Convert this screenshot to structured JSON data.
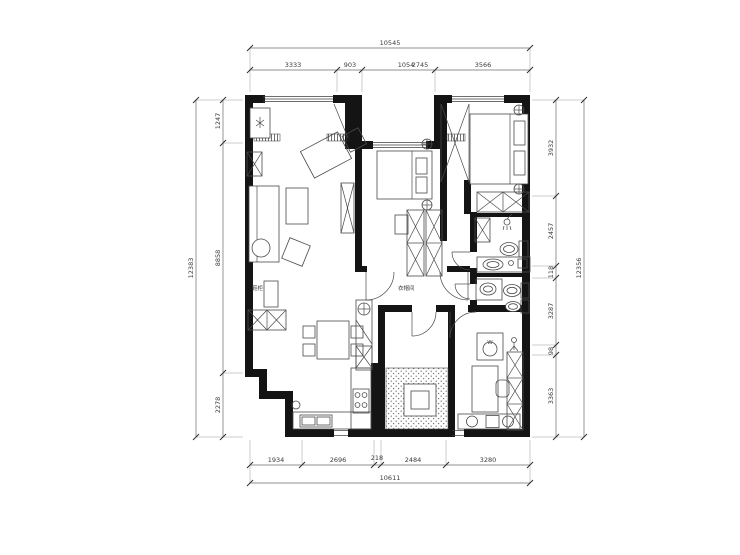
{
  "drawing": {
    "kind": "apartment floor plan (CAD line drawing with dimension chains)",
    "units": "mm"
  },
  "dims": {
    "top": {
      "total": "10545",
      "s1": "3333",
      "s2": "903",
      "s3a": "1054",
      "s3b": "2745",
      "s4": "3566"
    },
    "bottom": {
      "total": "10611",
      "s1": "1934",
      "s2": "2696",
      "s3": "218",
      "s4": "2484",
      "s5": "3280"
    },
    "left": {
      "total": "12383",
      "s1": "1247",
      "s2": "8858",
      "s3": "2278"
    },
    "right": {
      "total": "12356",
      "s1": "3932",
      "s2": "2457",
      "s3": "118",
      "s4": "3287",
      "s5": "98",
      "s6": "3363"
    }
  },
  "room_labels": {
    "shoe_cabinet": "鞋柜",
    "wardrobe": "衣帽间"
  },
  "appliance_labels": {
    "washer": "W"
  },
  "colors": {
    "wall": "#141414",
    "line": "#4a4a4a",
    "dimension": "#6b6b6b"
  }
}
